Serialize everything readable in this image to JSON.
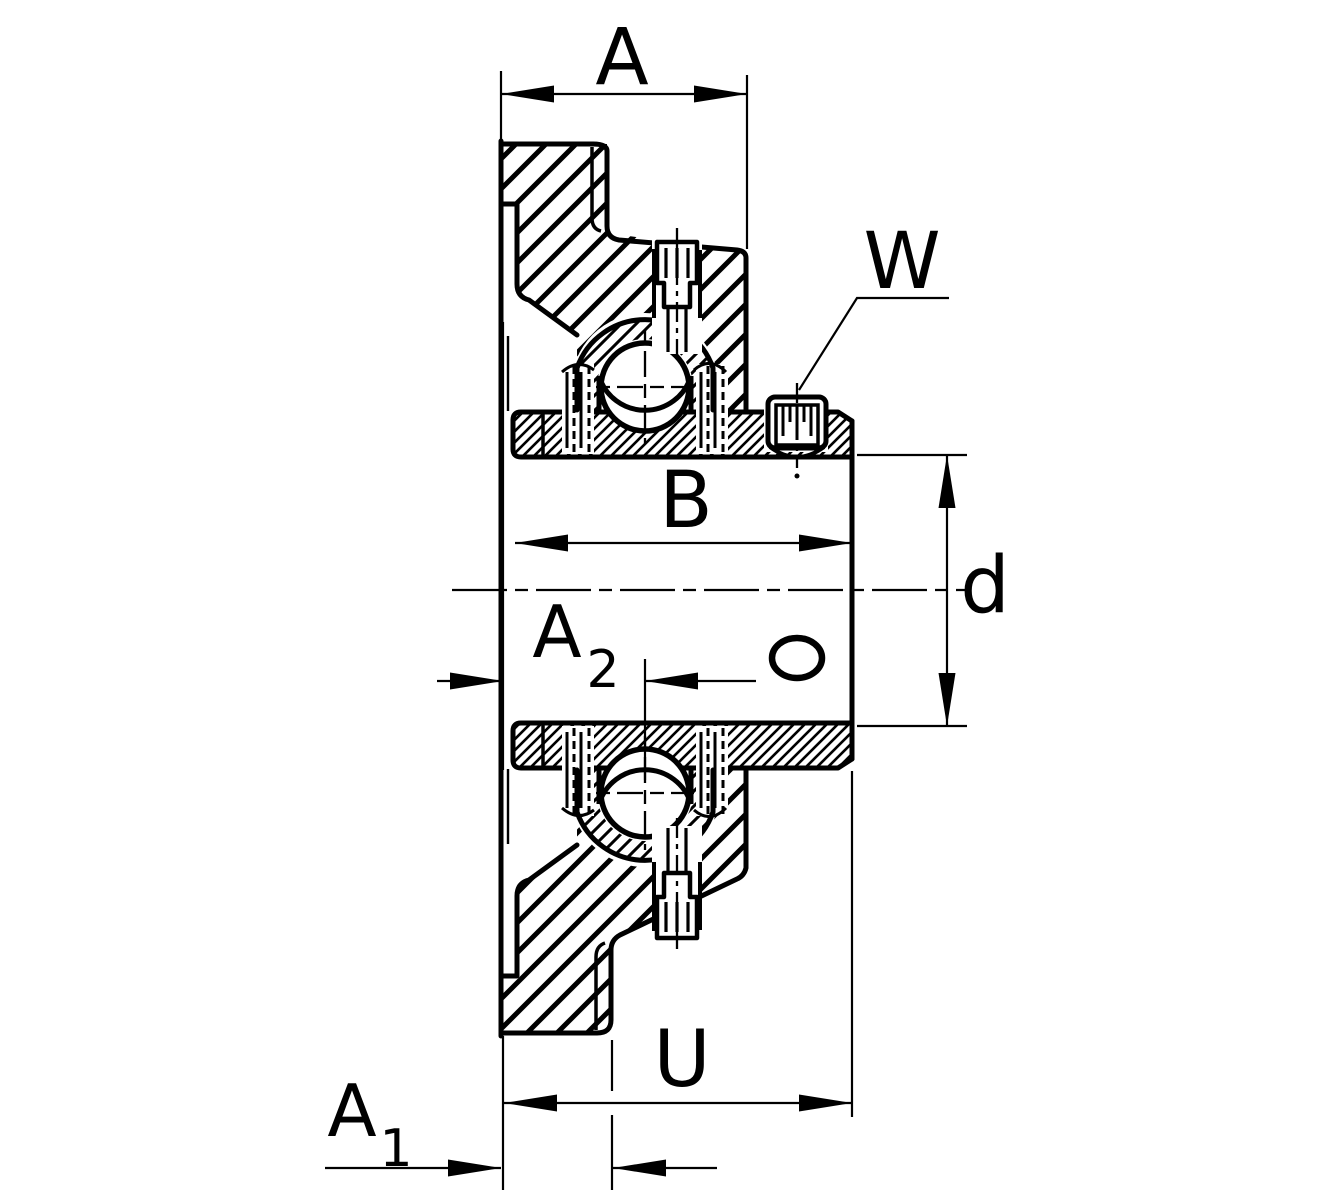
{
  "drawing": {
    "kind": "flanged-bearing-unit-cross-section",
    "labels": {
      "a": "A",
      "w": "W",
      "b": "B",
      "d": "d",
      "a2_base": "A",
      "a2_sub": "2",
      "u": "U",
      "a1_base": "A",
      "a1_sub": "1"
    },
    "colors": {
      "ink": "#000000",
      "paper": "#ffffff"
    }
  }
}
